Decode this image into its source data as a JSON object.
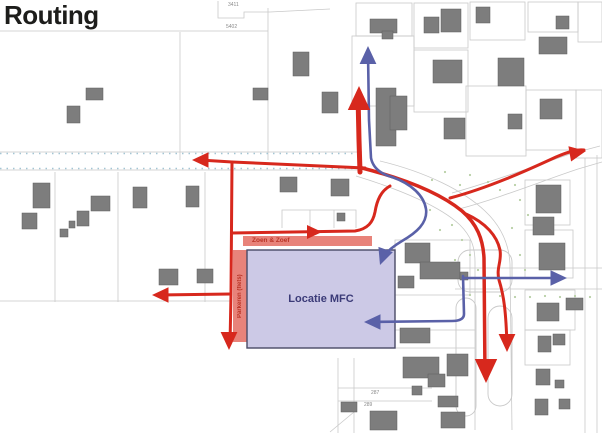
{
  "title": "Routing",
  "map": {
    "labels": {
      "mfc": "Locatie MFC",
      "zoen_zoef": "Zoen & Zoef",
      "parkeren": "Parkeren (fiets)",
      "parcel_3411": "3411",
      "parcel_5402": "5402",
      "parcel_287": "287",
      "parcel_289": "289"
    },
    "colors": {
      "red": "#d7281d",
      "blue": "#5a61a8",
      "building": "#7d7d7d",
      "parcel": "#c9c9c9",
      "roadTick": "#a3c6d4",
      "mfcFill": "#ccc9e6",
      "mfcBorder": "#4a4a66",
      "stripFill": "#e8837a",
      "stripText": "#b93425",
      "dot": "#b8cfa5",
      "labelGray": "#8a8a8a",
      "title": "#1d1d1b"
    },
    "parcel_lines": [
      "M0,31 H268",
      "M268,8 V160",
      "M180,32 V160",
      "M218,1 V18 H244 V12 H270",
      "M270,12 L330,9",
      "M0,152 H362",
      "M0,170 H360",
      "M55,172 V302",
      "M118,172 V302",
      "M205,172 V302",
      "M0,301 H232",
      "M282,228 V210 H356 V228",
      "M310,210 V228",
      "M334,210 V228",
      "M338,358 V433",
      "M354,358 V433",
      "M338,388 H432",
      "M338,401 H432",
      "M330,432 L354,412",
      "M455,268 H602",
      "M455,289 H602",
      "M585,158 V433",
      "M597,155 V433",
      "M452,193 C492,182 535,166 570,154 L600,146",
      "M459,209 C500,198 542,181 578,169 L602,162",
      "M356,176 C402,190 441,207 460,225 C471,236 475,247 475,262 L475,430",
      "M380,161 C426,172 464,191 485,211 C501,226 509,244 510,264 L512,430",
      "M395,240 H470 V295 H395 Z",
      "M340,330 H475",
      "M247,348 H475"
    ],
    "outline_rects": [
      [
        352,
        36,
        62,
        70
      ],
      [
        414,
        50,
        54,
        62
      ],
      [
        466,
        86,
        60,
        70
      ],
      [
        526,
        90,
        50,
        60
      ],
      [
        576,
        90,
        26,
        68
      ],
      [
        356,
        3,
        56,
        33
      ],
      [
        414,
        3,
        54,
        45
      ],
      [
        470,
        2,
        55,
        38
      ],
      [
        528,
        2,
        50,
        30
      ],
      [
        578,
        2,
        24,
        40
      ],
      [
        525,
        180,
        45,
        45
      ],
      [
        525,
        230,
        48,
        48
      ],
      [
        525,
        290,
        50,
        40
      ],
      [
        525,
        330,
        45,
        35
      ]
    ],
    "stadiums": [
      [
        456,
        298,
        20,
        118,
        10
      ],
      [
        488,
        306,
        24,
        100,
        12
      ],
      [
        458,
        250,
        54,
        42,
        12
      ]
    ],
    "road_ticks": [
      "M0,153.5 H360",
      "M0,168.5 H360"
    ],
    "dots": [
      [
        432,
        180
      ],
      [
        445,
        172
      ],
      [
        460,
        185
      ],
      [
        470,
        175
      ],
      [
        488,
        182
      ],
      [
        500,
        190
      ],
      [
        515,
        185
      ],
      [
        452,
        225
      ],
      [
        462,
        240
      ],
      [
        470,
        255
      ],
      [
        478,
        270
      ],
      [
        520,
        200
      ],
      [
        528,
        215
      ],
      [
        470,
        295
      ],
      [
        485,
        296
      ],
      [
        500,
        296
      ],
      [
        515,
        297
      ],
      [
        530,
        297
      ],
      [
        545,
        296
      ],
      [
        560,
        297
      ],
      [
        575,
        296
      ],
      [
        590,
        297
      ],
      [
        430,
        210
      ],
      [
        440,
        230
      ],
      [
        455,
        260
      ],
      [
        520,
        255
      ],
      [
        525,
        270
      ],
      [
        512,
        228
      ]
    ],
    "buildings": [
      [
        86,
        88,
        17,
        12
      ],
      [
        67,
        106,
        13,
        17
      ],
      [
        253,
        88,
        15,
        12
      ],
      [
        293,
        52,
        16,
        24
      ],
      [
        322,
        92,
        16,
        21
      ],
      [
        370,
        19,
        27,
        14
      ],
      [
        382,
        31,
        11,
        8
      ],
      [
        424,
        17,
        15,
        16
      ],
      [
        441,
        9,
        20,
        23
      ],
      [
        476,
        7,
        14,
        16
      ],
      [
        539,
        37,
        28,
        17
      ],
      [
        556,
        16,
        13,
        13
      ],
      [
        376,
        88,
        20,
        58
      ],
      [
        390,
        96,
        17,
        34
      ],
      [
        433,
        60,
        29,
        23
      ],
      [
        498,
        58,
        26,
        28
      ],
      [
        540,
        99,
        22,
        20
      ],
      [
        508,
        114,
        14,
        15
      ],
      [
        444,
        118,
        21,
        21
      ],
      [
        536,
        185,
        25,
        28
      ],
      [
        533,
        217,
        21,
        18
      ],
      [
        539,
        243,
        26,
        27
      ],
      [
        566,
        298,
        17,
        12
      ],
      [
        537,
        303,
        22,
        18
      ],
      [
        538,
        336,
        13,
        16
      ],
      [
        553,
        334,
        12,
        11
      ],
      [
        536,
        369,
        14,
        16
      ],
      [
        555,
        380,
        9,
        8
      ],
      [
        535,
        399,
        13,
        16
      ],
      [
        559,
        399,
        11,
        10
      ],
      [
        33,
        183,
        17,
        25
      ],
      [
        22,
        213,
        15,
        16
      ],
      [
        60,
        229,
        8,
        8
      ],
      [
        69,
        221,
        6,
        7
      ],
      [
        77,
        211,
        12,
        15
      ],
      [
        91,
        196,
        19,
        15
      ],
      [
        133,
        187,
        14,
        21
      ],
      [
        186,
        186,
        13,
        21
      ],
      [
        159,
        269,
        19,
        16
      ],
      [
        197,
        269,
        16,
        14
      ],
      [
        280,
        177,
        17,
        15
      ],
      [
        331,
        179,
        18,
        17
      ],
      [
        337,
        213,
        8,
        8
      ],
      [
        405,
        243,
        25,
        20
      ],
      [
        420,
        262,
        40,
        17
      ],
      [
        398,
        276,
        16,
        12
      ],
      [
        460,
        272,
        8,
        8
      ],
      [
        400,
        328,
        30,
        15
      ],
      [
        403,
        357,
        36,
        21
      ],
      [
        447,
        354,
        21,
        22
      ],
      [
        428,
        374,
        17,
        13
      ],
      [
        438,
        396,
        20,
        11
      ],
      [
        441,
        412,
        24,
        16
      ],
      [
        370,
        411,
        27,
        19
      ],
      [
        412,
        386,
        10,
        9
      ],
      [
        341,
        402,
        16,
        10
      ]
    ],
    "zones": [
      {
        "x": 233,
        "y": 250,
        "w": 14,
        "h": 92,
        "fill": "stripFill"
      },
      {
        "x": 243,
        "y": 236,
        "w": 129,
        "h": 10,
        "fill": "stripFill"
      },
      {
        "x": 247,
        "y": 250,
        "w": 148,
        "h": 98,
        "fill": "mfcFill",
        "stroke": "mfcBorder"
      }
    ],
    "red_routes": [
      {
        "d": "M360,172 L359,140 L358,95",
        "w": 5
      },
      {
        "d": "M365,168 L232,162 L200,160",
        "w": 3
      },
      {
        "d": "M232,162 L231,294 L230,344",
        "w": 3
      },
      {
        "d": "M231,294 L158,295",
        "w": 3
      },
      {
        "d": "M232,233 L355,231 C368,229 373,222 375,212 C377,200 381,191 390,186",
        "w": 3
      },
      {
        "d": "M362,168 C405,179 440,193 462,211 C477,224 483,239 484,258 L485,376",
        "w": 3.5
      },
      {
        "d": "M450,198 C488,188 528,170 556,157 C568,152 577,149 584,150",
        "w": 3
      },
      {
        "d": "M466,214 C486,223 497,236 500,250 C502,261 496,268 499,280 C504,296 506,312 507,346",
        "w": 3
      }
    ],
    "blue_routes": [
      {
        "d": "M368,52 L369,120 L371,158 C373,168 381,174 392,177",
        "w": 2.6
      },
      {
        "d": "M392,177 C412,184 424,196 426,209 C428,223 416,233 402,241 C392,247 385,253 381,260",
        "w": 2.6
      },
      {
        "d": "M463,278 L562,278",
        "w": 2.6
      },
      {
        "d": "M463,276 L464,314 C464,319 459,321 452,321 L369,322",
        "w": 2.6
      }
    ],
    "arrowheads": [
      {
        "x": 359,
        "y": 86,
        "r": 0,
        "s": 1.6,
        "c": "r"
      },
      {
        "x": 192,
        "y": 160,
        "r": 270,
        "s": 1.1,
        "c": "r"
      },
      {
        "x": 152,
        "y": 295,
        "r": 270,
        "s": 1.1,
        "c": "r"
      },
      {
        "x": 229,
        "y": 350,
        "r": 180,
        "s": 1.2,
        "c": "r"
      },
      {
        "x": 322,
        "y": 232,
        "r": 90,
        "s": 1.0,
        "c": "r"
      },
      {
        "x": 586,
        "y": 151,
        "r": 80,
        "s": 1.1,
        "c": "r"
      },
      {
        "x": 486,
        "y": 383,
        "r": 180,
        "s": 1.6,
        "c": "r"
      },
      {
        "x": 507,
        "y": 352,
        "r": 180,
        "s": 1.2,
        "c": "r"
      },
      {
        "x": 368,
        "y": 46,
        "r": 0,
        "s": 1.2,
        "c": "b"
      },
      {
        "x": 380,
        "y": 265,
        "r": 200,
        "s": 1.1,
        "c": "b"
      },
      {
        "x": 567,
        "y": 278,
        "r": 90,
        "s": 1.1,
        "c": "b"
      },
      {
        "x": 364,
        "y": 322,
        "r": 270,
        "s": 1.1,
        "c": "b"
      }
    ]
  }
}
